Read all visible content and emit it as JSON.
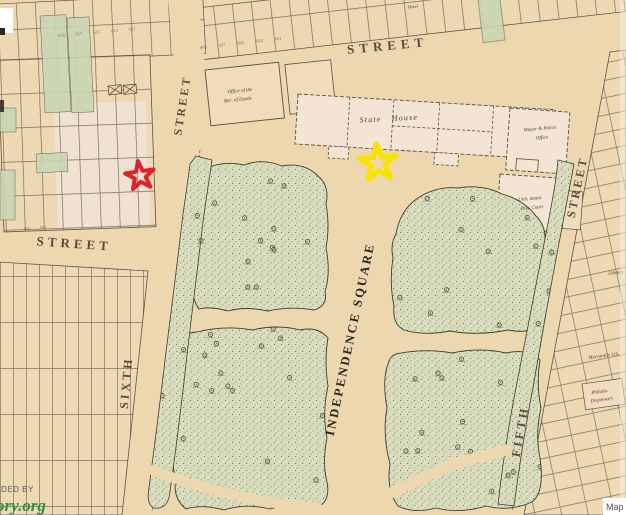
{
  "map": {
    "streets": {
      "top": "STREET",
      "west": "STREET",
      "sixth": "SIXTH",
      "sixth_upper": "STREET",
      "fifth": "FIFTH",
      "fifth_upper": "STREET"
    },
    "square_name": "INDEPENDENCE SQUARE",
    "buildings": {
      "state_house": "State House",
      "rec_deeds_line1": "Office of the",
      "rec_deeds_line2": "Rec. of Deeds",
      "mayor_line1": "Mayor & Police",
      "mayor_line2": "Office",
      "court_line1": "Unit. States",
      "court_line2": "Dist. Court",
      "library": "Library",
      "mercantile": "Mercantile Lib.",
      "dispensary_line1": "Philada.",
      "dispensary_line2": "Dispensary",
      "hotel": "Hotel"
    },
    "lot_numbers": {
      "row_a": "619 617 615 613 611",
      "row_b": "609 607 605 603 601",
      "row_c": "605 603"
    }
  },
  "markers": {
    "red_star": {
      "shape": "star",
      "color": "#e3202b"
    },
    "yellow_star": {
      "shape": "star",
      "color": "#f7e400"
    }
  },
  "attribution": {
    "provided_by": "DED BY",
    "site": "ory.org",
    "map_credit": "Map"
  },
  "palette": {
    "paper": "#ecd7ae",
    "park": "#d9dcbd",
    "ink": "#4f4a3b",
    "green_lot": "#c9d6b4",
    "pink_lot": "#f3e4d4"
  }
}
